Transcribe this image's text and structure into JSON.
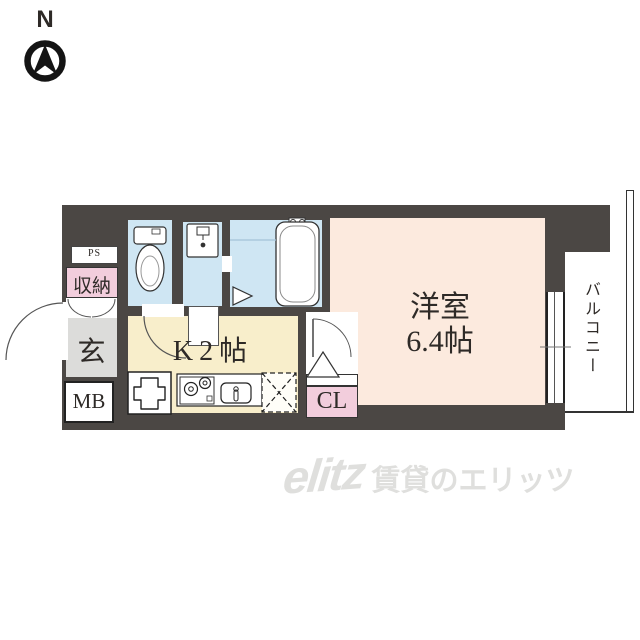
{
  "compass": {
    "north_label": "N"
  },
  "plan": {
    "labels": {
      "ps": "PS",
      "storage": "収納",
      "entrance": "玄",
      "meter_box": "MB",
      "kitchen": "K2帖",
      "closet": "CL",
      "main_room": "洋室",
      "main_room_size": "6.4帖",
      "balcony": "バルコニー"
    },
    "colors": {
      "wall": "#4b4744",
      "wet_room_floor": "#cfe6f3",
      "kitchen_floor": "#f8eecb",
      "main_room_floor": "#fceade",
      "closet_pink": "#f2cddc",
      "entrance_gray": "#dcdcda"
    }
  },
  "watermark": {
    "logo": "elitz",
    "text": "賃貸のエリッツ"
  }
}
